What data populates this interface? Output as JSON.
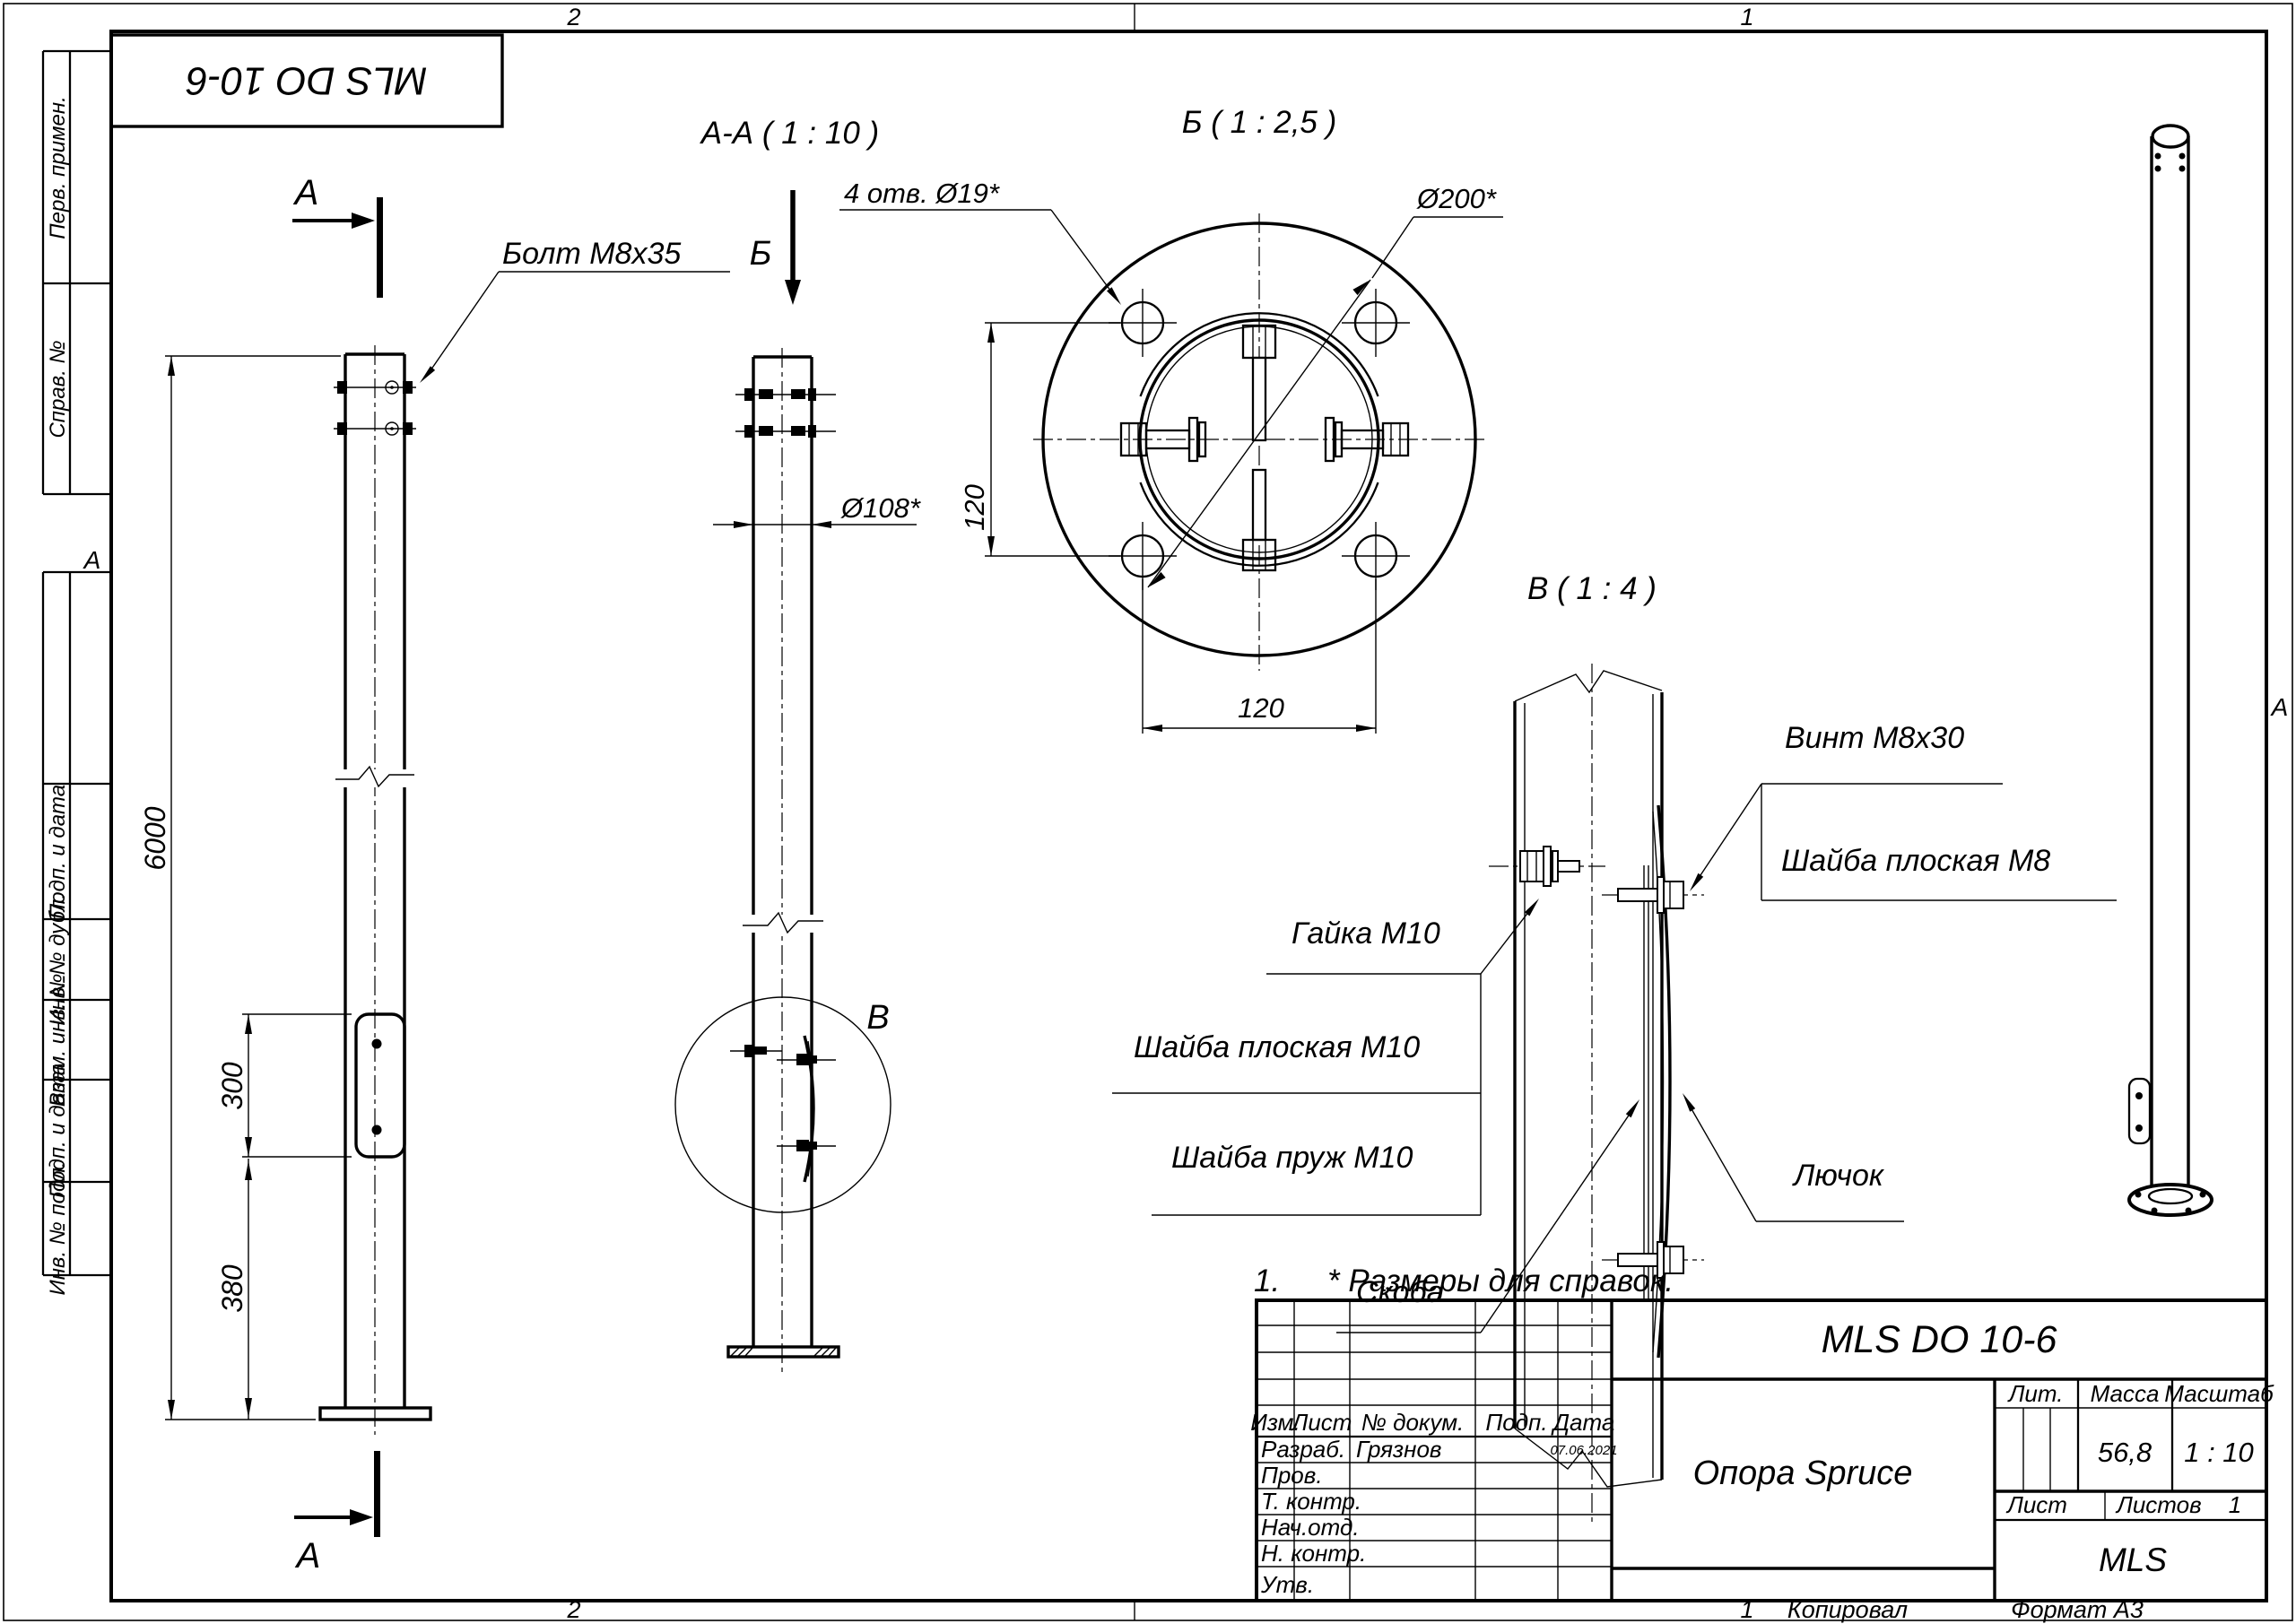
{
  "sheet": {
    "zone_top_left": "2",
    "zone_top_right": "1",
    "zone_bottom_left": "2",
    "zone_bottom_right": "1",
    "zone_letter_left": "А",
    "zone_letter_right": "А",
    "copied": "Копировал",
    "format": "Формат А3"
  },
  "stamp_top_left": "MLS DO 10-6",
  "sidebar": {
    "labels": [
      "Перв. примен.",
      "Справ. №",
      "Подп. и дата",
      "Инв. № дубл.",
      "Взам. инв. №",
      "Подп. и дата",
      "Инв. № подл."
    ]
  },
  "front": {
    "marker_top": "А",
    "marker_bottom": "А",
    "bolt_label": "Болт М8х35",
    "dim_height": "6000",
    "dim_hatch": "300",
    "dim_base": "380"
  },
  "aa": {
    "title": "А-А ( 1 : 10 )",
    "marker": "Б",
    "dia": "Ø108*",
    "detail_letter": "В"
  },
  "b": {
    "title": "Б ( 1 : 2,5 )",
    "holes": "4 отв. Ø19*",
    "outer": "Ø200*",
    "dim_v": "120",
    "dim_h": "120"
  },
  "v": {
    "title": "В ( 1 : 4 )",
    "vint": "Винт М8х30",
    "shayba_m8": "Шайба плоская М8",
    "gayka": "Гайка М10",
    "shayba_m10": "Шайба плоская М10",
    "shayba_pruzh": "Шайба пруж М10",
    "skoba": "Скоба",
    "lyuchok": "Лючок"
  },
  "note": {
    "num": "1.",
    "text": "* Размеры для справок."
  },
  "tb": {
    "doc": "MLS DO 10-6",
    "name": "Опора Spruce",
    "org": "MLS",
    "h_izm": "Изм.",
    "h_list": "Лист",
    "h_doc": "№ докум.",
    "h_podp": "Подп.",
    "h_data": "Дата",
    "h_lit": "Лит.",
    "h_massa": "Масса",
    "h_scale": "Масштаб",
    "h_sheet": "Лист",
    "h_sheets": "Листов",
    "rows": [
      {
        "label": "Разраб.",
        "name": "Грязнов",
        "date": "07.06.2021"
      },
      {
        "label": "Пров.",
        "name": "",
        "date": ""
      },
      {
        "label": "Т. контр.",
        "name": "",
        "date": ""
      },
      {
        "label": "Нач.отд.",
        "name": "",
        "date": ""
      },
      {
        "label": "Н. контр.",
        "name": "",
        "date": ""
      },
      {
        "label": "Утв.",
        "name": "",
        "date": ""
      }
    ],
    "massa": "56,8",
    "scale": "1 : 10",
    "sheets_num": "1"
  }
}
